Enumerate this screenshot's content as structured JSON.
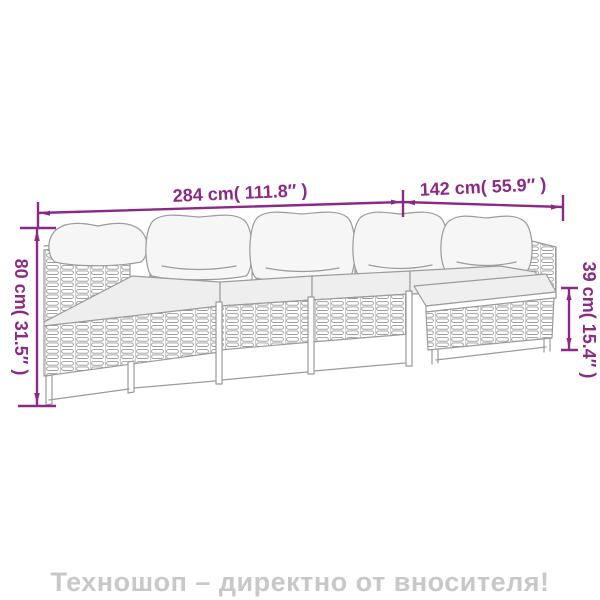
{
  "page": {
    "background": "#ffffff"
  },
  "diagram": {
    "accent_color": "#8b2a86",
    "sketch_color": "#9b9b9b",
    "figure_name": "5-piece poly rattan garden sofa set line drawing",
    "dimensions": {
      "total_width": {
        "label": "284 cm( 111.8″ )"
      },
      "right_section_width": {
        "label": "142 cm( 55.9″ )"
      },
      "back_height": {
        "label": "80 cm( 31.5″ )"
      },
      "seat_height": {
        "label": "39 cm( 15.4″ )"
      }
    }
  },
  "footer": {
    "watermark": "Техношоп – директно от вносителя!",
    "color": "#c8c8c8"
  }
}
